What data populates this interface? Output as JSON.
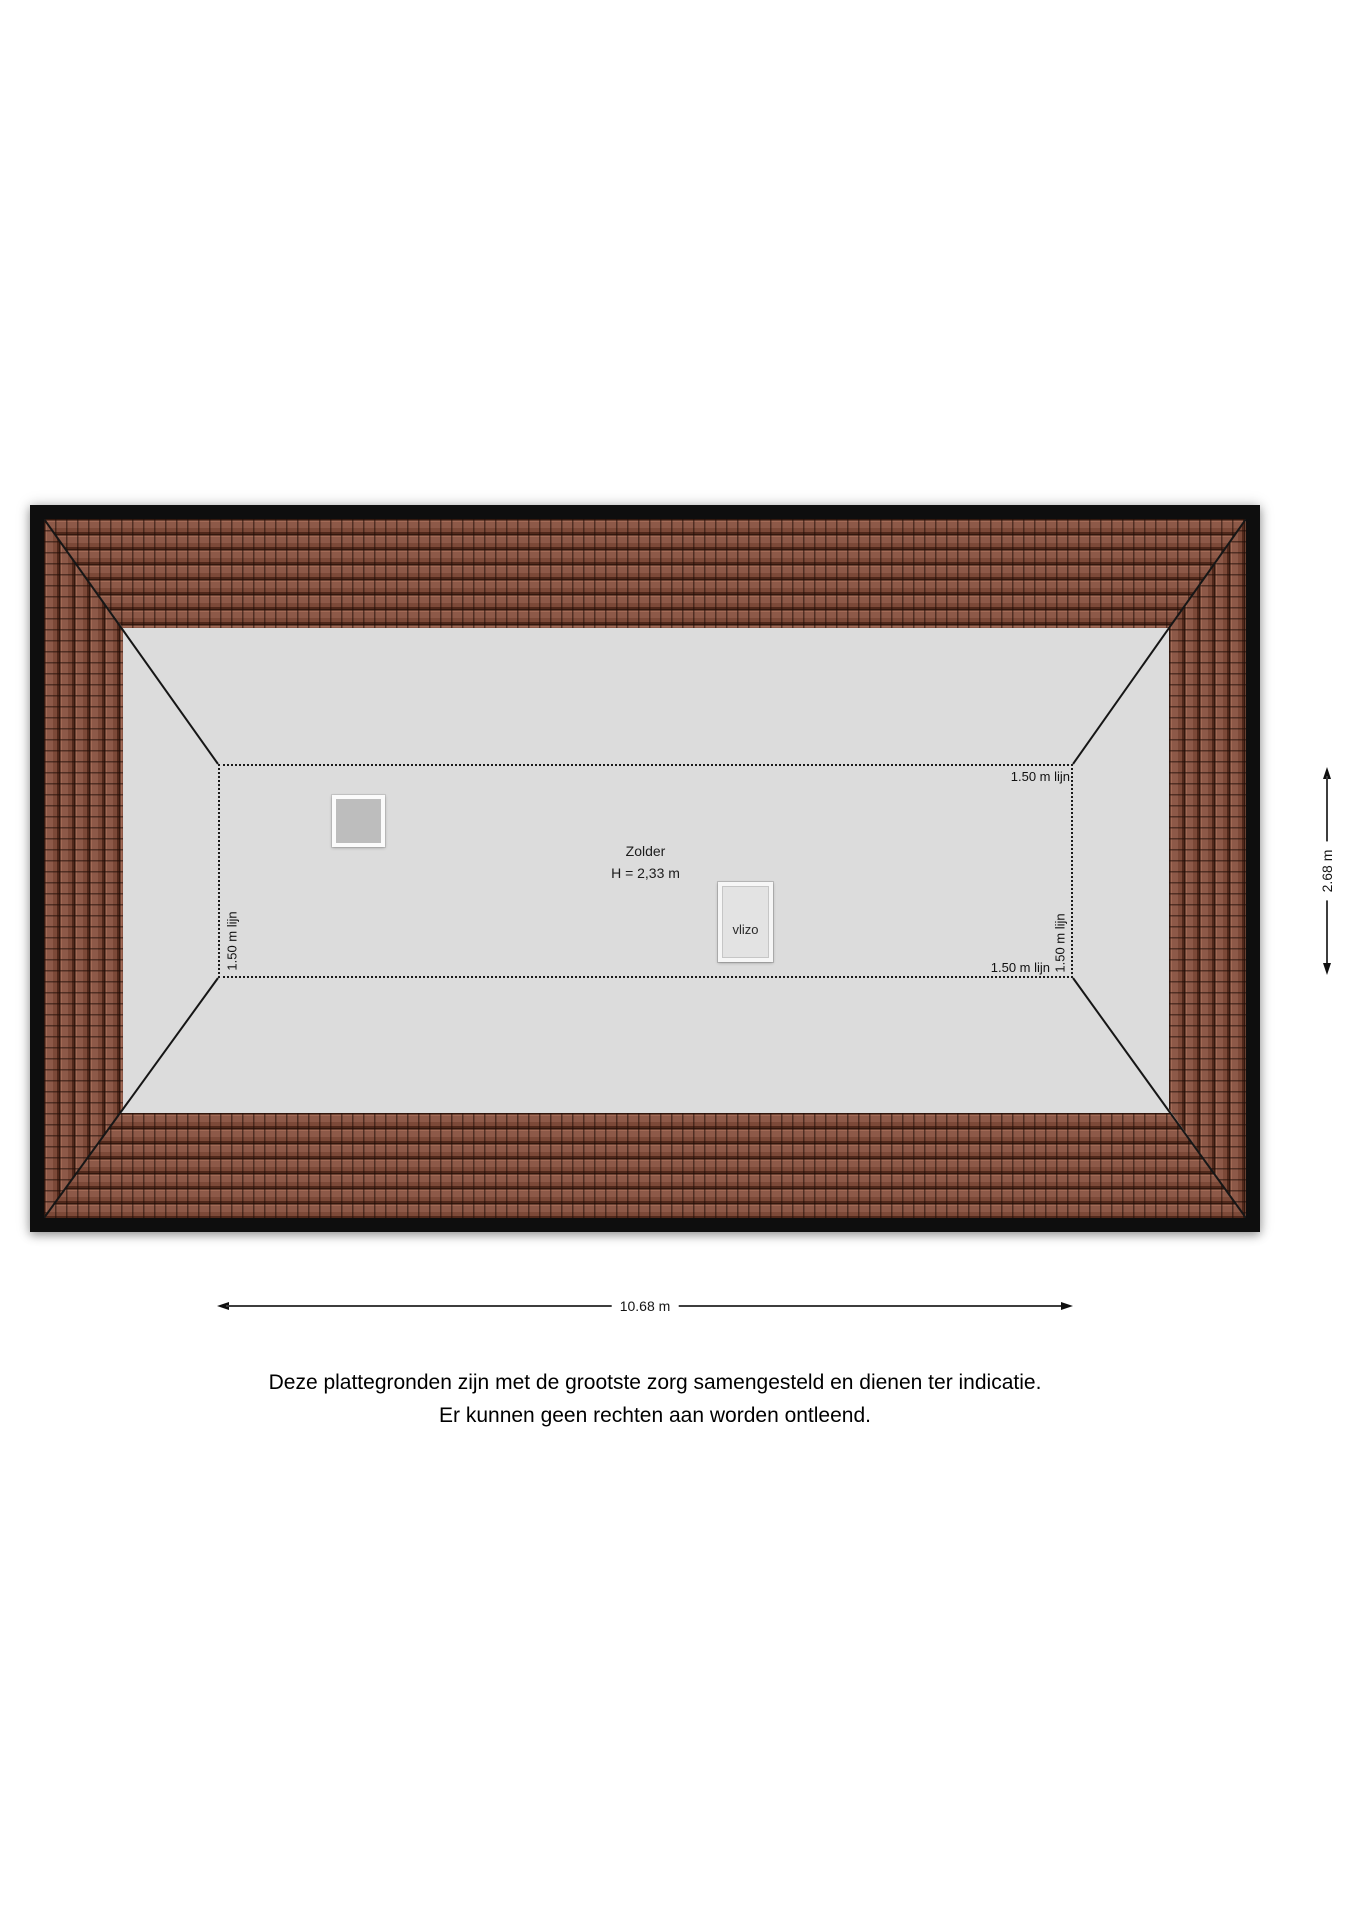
{
  "plan": {
    "room": {
      "name": "Zolder",
      "height_label": "H = 2,33 m"
    },
    "vlizo_label": "vlizo",
    "knee_wall_line_label": "1.50 m lijn",
    "dimensions": {
      "width": "10.68 m",
      "depth": "2.68 m"
    },
    "colors": {
      "roof_tile": "#8d5948",
      "roof_tile_dark": "#33180e",
      "attic_floor": "#dcdcdc",
      "frame": "#0e0e0e",
      "line": "#1a1a1a"
    }
  },
  "disclaimer": {
    "line1": "Deze plattegronden zijn met de grootste zorg samengesteld en dienen ter indicatie.",
    "line2": "Er kunnen geen rechten aan worden ontleend."
  }
}
